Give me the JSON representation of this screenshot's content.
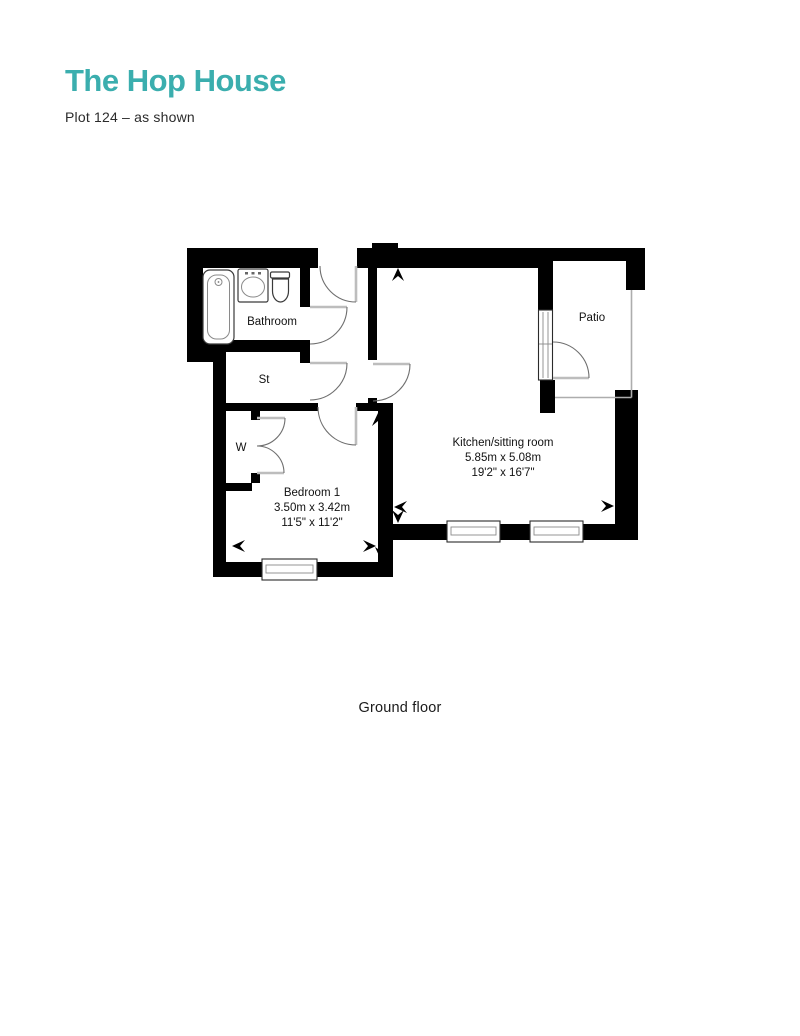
{
  "header": {
    "title": "The Hop House",
    "subtitle": "Plot 124 – as shown"
  },
  "footer": {
    "floor_label": "Ground floor"
  },
  "colors": {
    "accent_teal": "#3BAEAE",
    "wall_black": "#000000",
    "label_text": "#111111"
  },
  "rooms": {
    "bathroom": {
      "name": "Bathroom"
    },
    "storage": {
      "name": "St"
    },
    "wardrobe": {
      "name": "W"
    },
    "bedroom": {
      "name": "Bedroom 1",
      "metric": "3.50m x 3.42m",
      "imperial": "11'5\" x 11'2\""
    },
    "kitchen": {
      "name": "Kitchen/sitting room",
      "metric": "5.85m x 5.08m",
      "imperial": "19'2\" x 16'7\""
    },
    "patio": {
      "name": "Patio"
    }
  }
}
